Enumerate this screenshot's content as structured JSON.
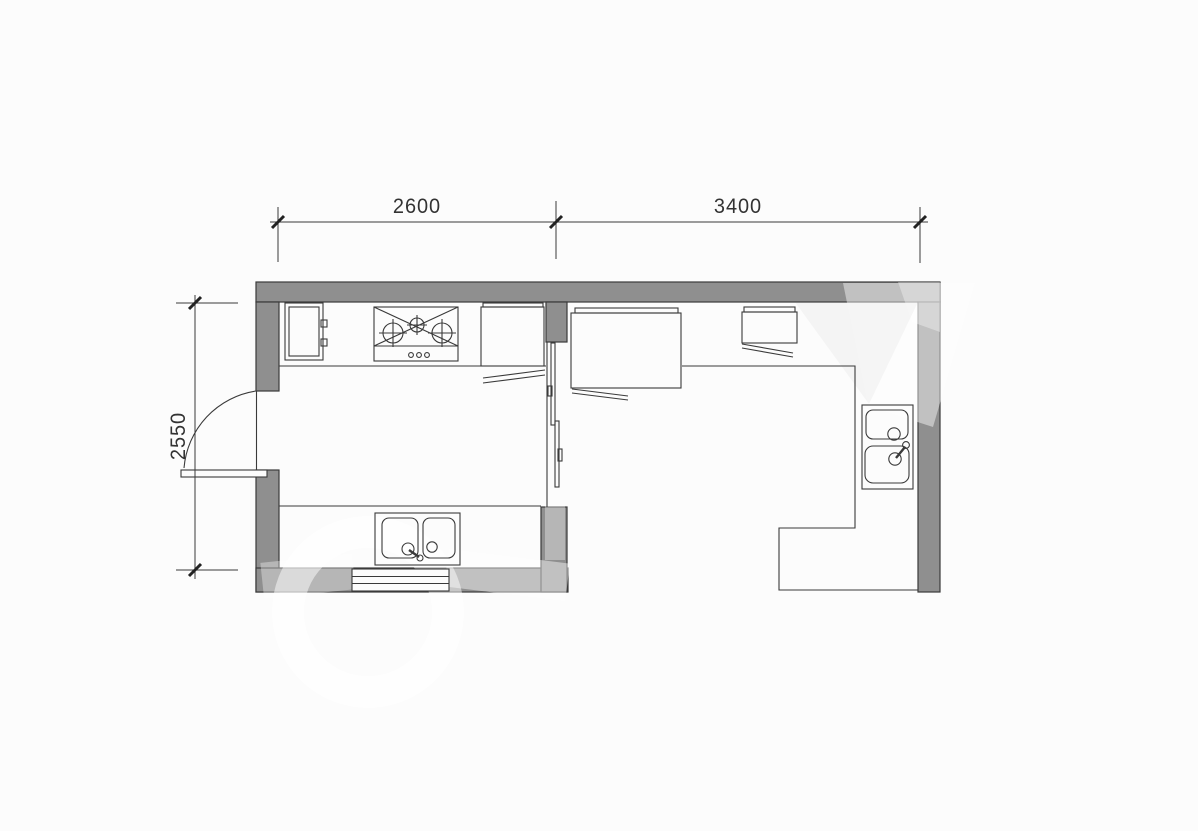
{
  "document": {
    "type": "architectural-floor-plan",
    "subject": "kitchen-and-utility-room-plan"
  },
  "dimensions": {
    "top_left": {
      "value": "2600"
    },
    "top_right": {
      "value": "3400"
    },
    "left": {
      "value": "2550"
    }
  },
  "colors": {
    "background": "#fcfcfc",
    "wall_fill": "#8f8f8f",
    "line": "#3a3a3a",
    "dimension_text": "#333333",
    "watermark": "rgba(255,255,255,0.45)"
  },
  "fixtures": [
    "refrigerator-cabinet",
    "gas-stove-3-burner",
    "wall-cabinet-open-door",
    "double-basin-sink-horizontal",
    "window",
    "hinged-entry-door",
    "sliding-door",
    "large-appliance-open-door",
    "overhead-cabinet-open-door",
    "l-shaped-counter",
    "double-basin-sink-vertical"
  ]
}
